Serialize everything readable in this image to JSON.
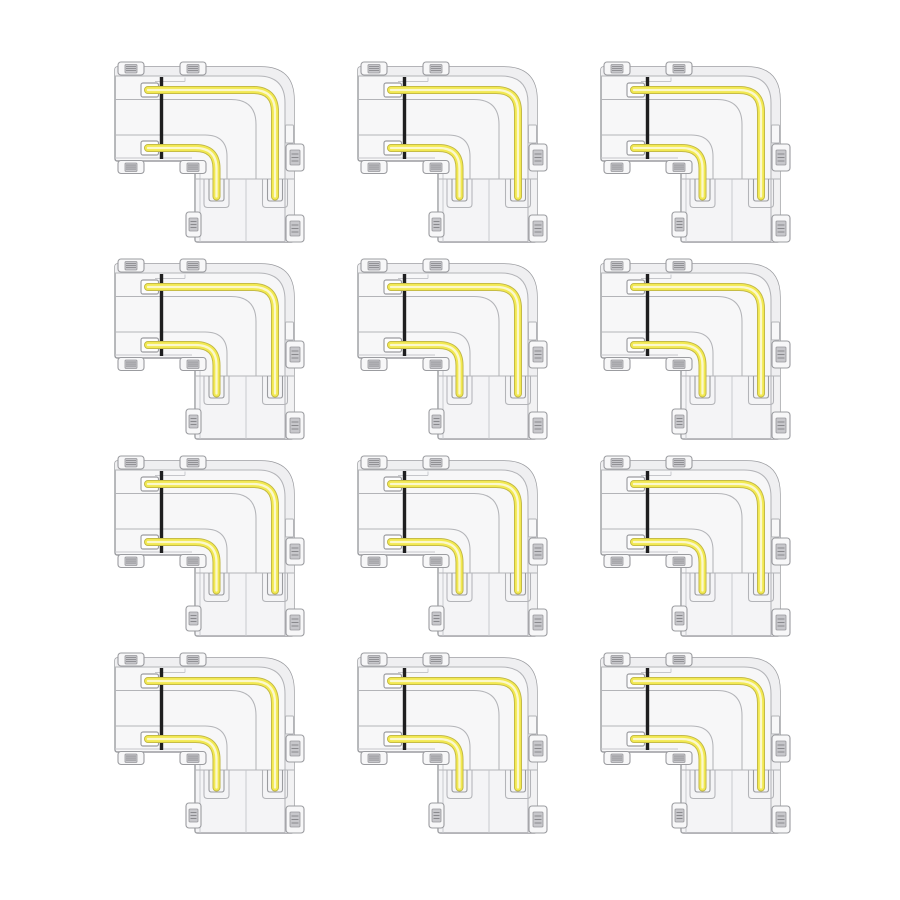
{
  "page": {
    "background_color": "#ffffff",
    "description": "Product image: grid of identical transparent L-shape LED strip corner connectors with yellow light strips"
  },
  "product_grid": {
    "rows": 4,
    "cols": 3,
    "item_count": 12,
    "item_name": "l-shape-corner-connector"
  },
  "colors": {
    "page_bg": "#ffffff",
    "body_fill": "#f7f7f8",
    "rim_fill": "#efeff1",
    "panel_fill": "#f2f2f4",
    "outline": "#9b9ca0",
    "outline_light": "#b3b4b8",
    "outline_faint": "#c5c6ca",
    "contact_fill": "#c7c7cb",
    "contact_edge": "#98989c",
    "contact_ridge": "#8a8a8e",
    "dark_line": "#1f1f20",
    "cap_fill": "#fdfdfe",
    "strip_edge": "#bfb545",
    "strip_main": "#f2e951",
    "strip_core": "#fbf8cc"
  }
}
